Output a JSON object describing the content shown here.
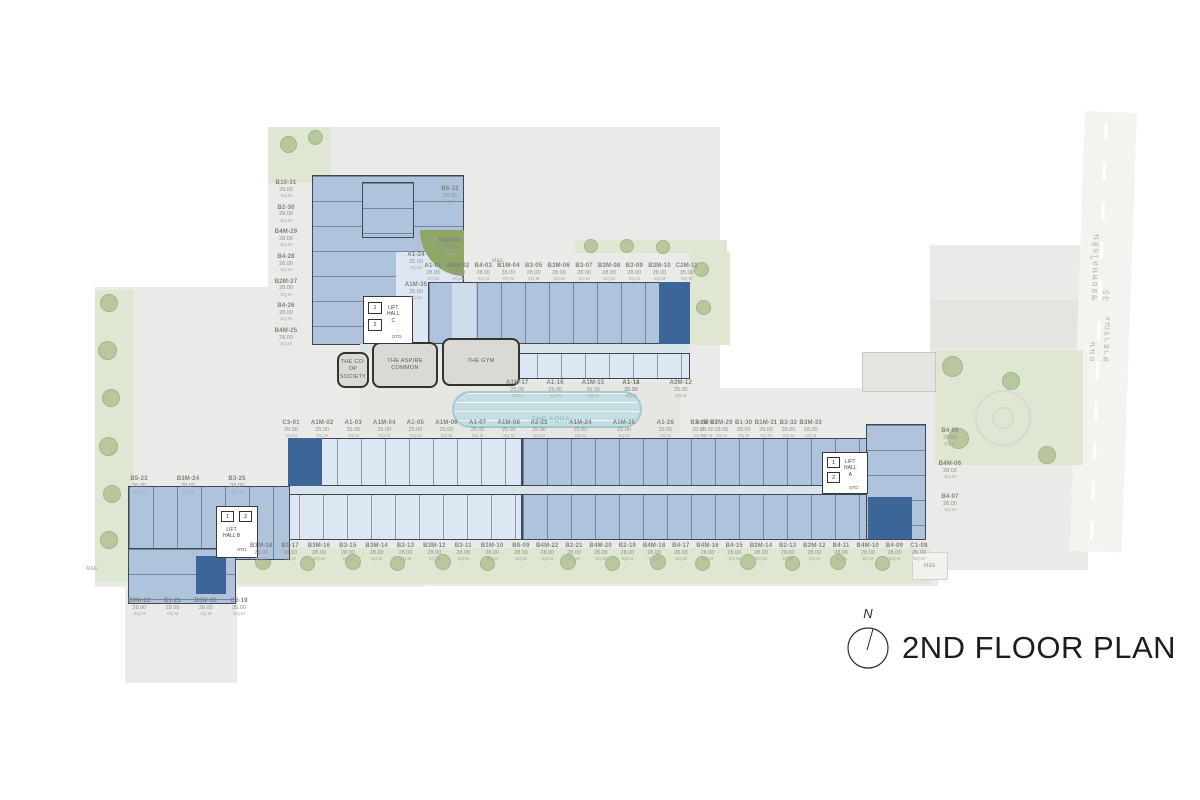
{
  "title": "2ND FLOOR PLAN",
  "compass_label": "N",
  "road": {
    "line1": "ถนนสาธารณะ",
    "line2": "ซอยพหลโยธิน 35"
  },
  "unit_suffix": "SQ.M",
  "misc": {
    "me": "M&E"
  },
  "amenities": {
    "coop": "THE CO-OP\nSOCIETY",
    "aspire": "THE ASPIRE\nCOMMON",
    "gym": "THE GYM",
    "aqua": "THE AQUA"
  },
  "lift_halls": {
    "a": {
      "name": "LIFT\nHALL\nA",
      "lift1": "1",
      "lift2": "2",
      "sto": "STO."
    },
    "b": {
      "name": "LIFT\nHALL B",
      "lift1": "1",
      "lift2": "2",
      "sto": "STO."
    },
    "c": {
      "name": "LIFT\nHALL\nC",
      "lift1": "1",
      "lift2": "2",
      "sto": "STO."
    }
  },
  "labels": {
    "west_wing": [
      {
        "id": "B10-31",
        "area": "28.00"
      },
      {
        "id": "B2-30",
        "area": "28.00"
      },
      {
        "id": "B4M-29",
        "area": "28.00"
      },
      {
        "id": "B4-28",
        "area": "28.00"
      },
      {
        "id": "B2M-27",
        "area": "28.00"
      },
      {
        "id": "B4-26",
        "area": "28.00"
      },
      {
        "id": "B4M-25",
        "area": "28.00"
      }
    ],
    "north_block": [
      {
        "id": "B6-32",
        "area": "28.00"
      },
      {
        "id": "B4M-33",
        "area": "28.00"
      }
    ],
    "lift_c_units": [
      {
        "id": "A1-24",
        "area": "25.00"
      },
      {
        "id": "A1M-35",
        "area": "25.00"
      }
    ],
    "top_row": [
      {
        "id": "A1-01",
        "area": "28.00"
      },
      {
        "id": "B4M-02",
        "area": "28.00"
      },
      {
        "id": "B4-03",
        "area": "28.00"
      },
      {
        "id": "B1M-04",
        "area": "35.00"
      },
      {
        "id": "B3-05",
        "area": "28.00"
      },
      {
        "id": "B3M-06",
        "area": "28.00"
      },
      {
        "id": "B3-07",
        "area": "28.00"
      },
      {
        "id": "B3M-08",
        "area": "28.00"
      },
      {
        "id": "B3-09",
        "area": "28.00"
      },
      {
        "id": "B3M-10",
        "area": "28.00"
      },
      {
        "id": "C2M-11",
        "area": "35.00"
      }
    ],
    "mid_row_west": [
      {
        "id": "A1M-17",
        "area": "25.00"
      },
      {
        "id": "A1-16",
        "area": "25.00"
      },
      {
        "id": "A1M-15",
        "area": "25.00"
      },
      {
        "id": "A1-14",
        "area": "25.00"
      }
    ],
    "mid_row_east": [
      {
        "id": "A1-13",
        "area": "25.00"
      },
      {
        "id": "A2M-12",
        "area": "25.00"
      }
    ],
    "central_row_west": [
      {
        "id": "C3-01",
        "area": "35.00"
      },
      {
        "id": "A1M-02",
        "area": "25.00"
      },
      {
        "id": "A1-03",
        "area": "25.00"
      },
      {
        "id": "A1M-04",
        "area": "25.00"
      },
      {
        "id": "A1-05",
        "area": "25.00"
      },
      {
        "id": "A1M-06",
        "area": "25.00"
      },
      {
        "id": "A1-07",
        "area": "25.00"
      },
      {
        "id": "A1M-08",
        "area": "25.00"
      }
    ],
    "central_row_mid": [
      {
        "id": "A2-23",
        "area": "25.00"
      },
      {
        "id": "A1M-24",
        "area": "25.00"
      },
      {
        "id": "A1M-25",
        "area": "25.00"
      },
      {
        "id": "A1-26",
        "area": "25.00"
      },
      {
        "id": "A1M-27",
        "area": "25.00"
      }
    ],
    "central_row_east": [
      {
        "id": "B3-28",
        "area": "28.00"
      },
      {
        "id": "B3M-29",
        "area": "28.00"
      },
      {
        "id": "B1-30",
        "area": "28.00"
      },
      {
        "id": "B1M-31",
        "area": "28.00"
      },
      {
        "id": "B3-32",
        "area": "28.00"
      },
      {
        "id": "B3M-33",
        "area": "28.00"
      }
    ],
    "east_col": [
      {
        "id": "B4-05",
        "area": "28.00"
      },
      {
        "id": "B4M-06",
        "area": "28.00"
      },
      {
        "id": "B4-07",
        "area": "28.00"
      }
    ],
    "southwest_top": [
      {
        "id": "B5-23",
        "area": "38.00"
      },
      {
        "id": "B3M-24",
        "area": "28.00"
      },
      {
        "id": "B3-25",
        "area": "38.00"
      }
    ],
    "southwest_bottom": [
      {
        "id": "B9M-22",
        "area": "28.00"
      },
      {
        "id": "B1-21",
        "area": "28.00"
      },
      {
        "id": "B3M-20",
        "area": "28.00"
      },
      {
        "id": "C2-19",
        "area": "35.00"
      }
    ],
    "south_row_west": [
      {
        "id": "B1M-18",
        "area": "28.00"
      },
      {
        "id": "B1-17",
        "area": "28.00"
      },
      {
        "id": "B3M-16",
        "area": "28.00"
      },
      {
        "id": "B3-15",
        "area": "28.00"
      },
      {
        "id": "B3M-14",
        "area": "28.00"
      },
      {
        "id": "B3-13",
        "area": "28.00"
      },
      {
        "id": "B3M-12",
        "area": "28.00"
      },
      {
        "id": "B3-11",
        "area": "28.00"
      },
      {
        "id": "B1M-10",
        "area": "28.00"
      },
      {
        "id": "B9-09",
        "area": "28.00"
      }
    ],
    "south_row_east": [
      {
        "id": "B4M-22",
        "area": "28.00"
      },
      {
        "id": "B2-21",
        "area": "28.00"
      },
      {
        "id": "B4M-20",
        "area": "28.00"
      },
      {
        "id": "B2-19",
        "area": "28.00"
      },
      {
        "id": "B4M-18",
        "area": "28.00"
      },
      {
        "id": "B4-17",
        "area": "28.00"
      },
      {
        "id": "B4M-16",
        "area": "28.00"
      },
      {
        "id": "B4-15",
        "area": "28.00"
      },
      {
        "id": "B2M-14",
        "area": "28.00"
      },
      {
        "id": "B2-13",
        "area": "28.00"
      },
      {
        "id": "B2M-12",
        "area": "28.00"
      },
      {
        "id": "B4-11",
        "area": "28.00"
      },
      {
        "id": "B4M-10",
        "area": "28.00"
      },
      {
        "id": "B4-09",
        "area": "28.00"
      },
      {
        "id": "C1-08",
        "area": "35.00"
      }
    ]
  }
}
